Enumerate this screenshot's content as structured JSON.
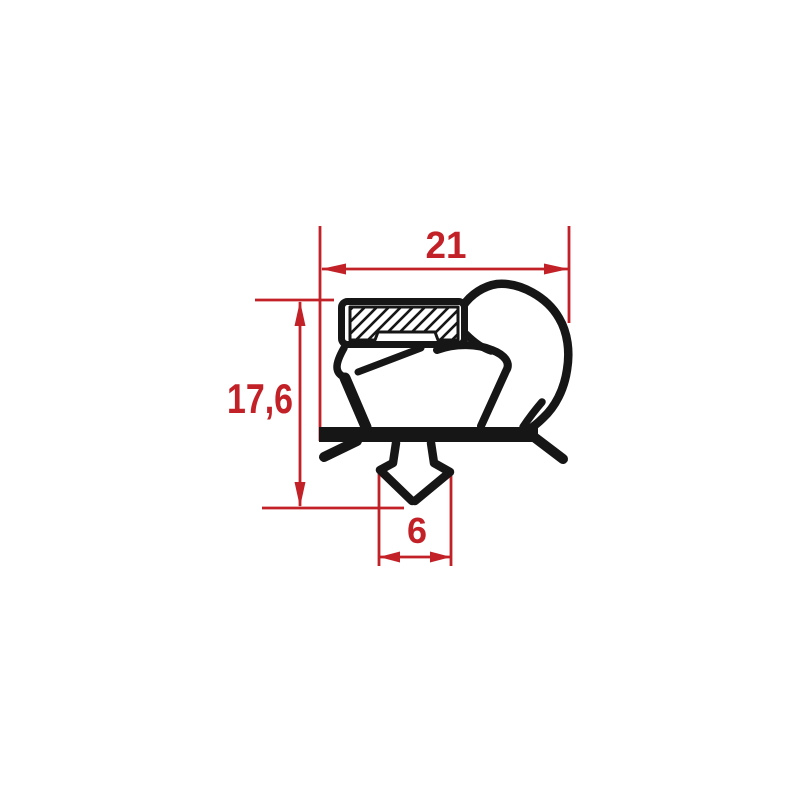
{
  "colors": {
    "dimension": "#c32128",
    "profile": "#161616",
    "background": "#ffffff"
  },
  "dimensions": {
    "width": {
      "label": "21"
    },
    "height": {
      "label": "17,6"
    },
    "anchor_width": {
      "label": "6"
    }
  }
}
